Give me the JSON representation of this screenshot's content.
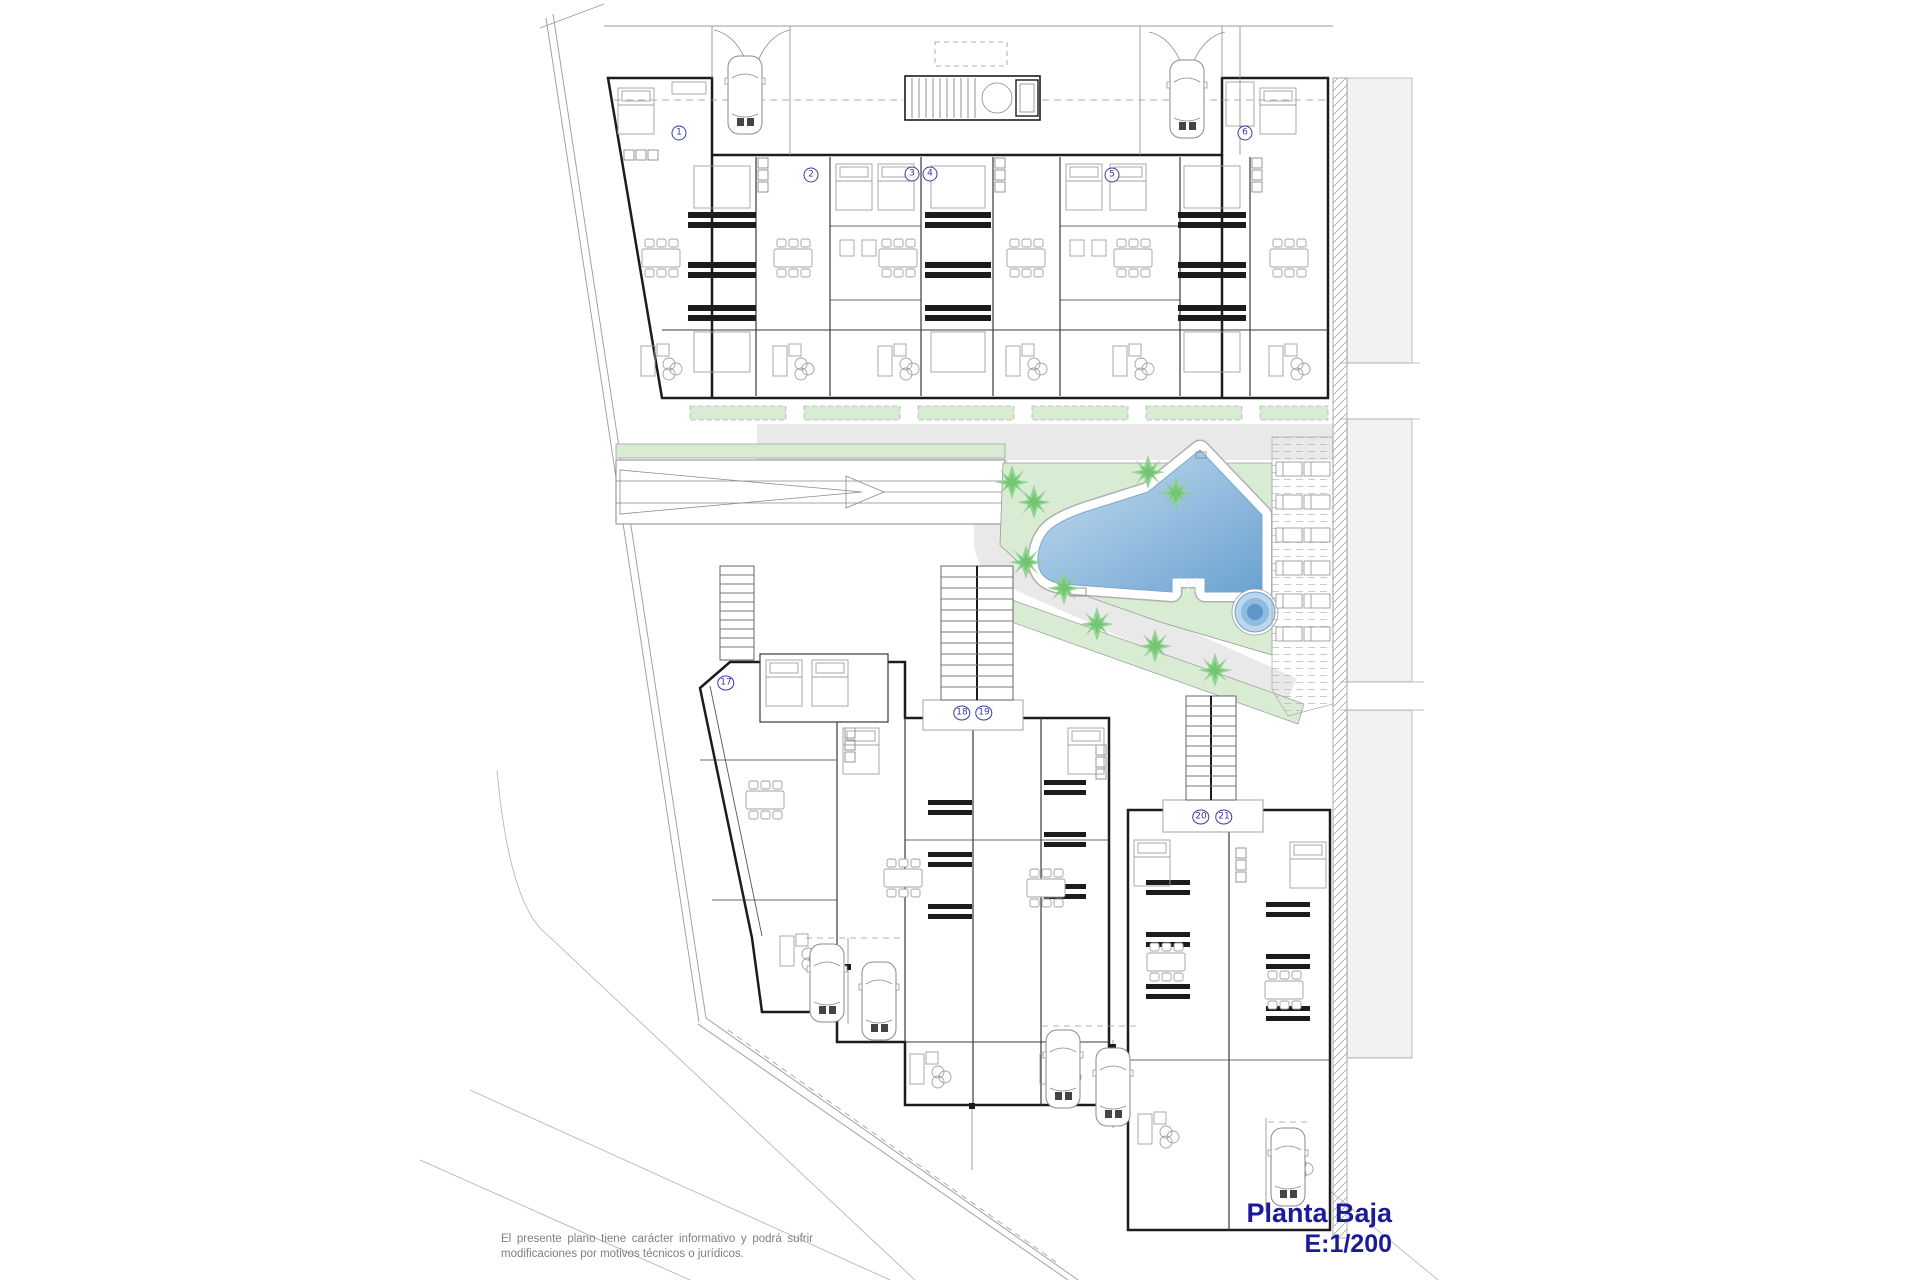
{
  "title": {
    "name": "Planta Baja",
    "scale": "E:1/200"
  },
  "disclaimer": {
    "line1": "El presente plano tiene carácter informativo y podrá sufrir",
    "line2": "modificaciones por motivos técnicos o jurídicos."
  },
  "drawing": {
    "type": "architectural-floor-plan",
    "floor_label": "Planta Baja",
    "scale_ratio": "1:200",
    "unit_markers": [
      {
        "label": "1",
        "x": 679,
        "y": 133
      },
      {
        "label": "2",
        "x": 811,
        "y": 175
      },
      {
        "label": "3",
        "x": 912,
        "y": 174
      },
      {
        "label": "4",
        "x": 930,
        "y": 174
      },
      {
        "label": "5",
        "x": 1112,
        "y": 175
      },
      {
        "label": "6",
        "x": 1245,
        "y": 133
      },
      {
        "label": "17",
        "x": 726,
        "y": 683
      },
      {
        "label": "18",
        "x": 962,
        "y": 713
      },
      {
        "label": "19",
        "x": 984,
        "y": 713
      },
      {
        "label": "20",
        "x": 1201,
        "y": 817
      },
      {
        "label": "21",
        "x": 1224,
        "y": 817
      }
    ],
    "features": [
      "swimming-pool",
      "jacuzzi",
      "sun-deck",
      "palm-trees",
      "garage-ramp",
      "stairs",
      "parking-bays",
      "landscaped-garden"
    ],
    "counts": {
      "units_labeled": 11,
      "cars": 7,
      "palm_trees": 9,
      "sun_loungers": 12
    }
  },
  "colors": {
    "pool_light": "#c6def1",
    "pool_dark": "#6ba2d0",
    "lawn_green": "#d8ecd4",
    "palm_green": "#7ccc7c",
    "path_gray": "#e9e9e9",
    "neighbor_gray": "#f1f1f1",
    "wall_black": "#1c1c1c",
    "marker_navy": "#3a3a9e",
    "title_navy": "#1b1b99",
    "disclaimer_gray": "#7f7f7f"
  }
}
